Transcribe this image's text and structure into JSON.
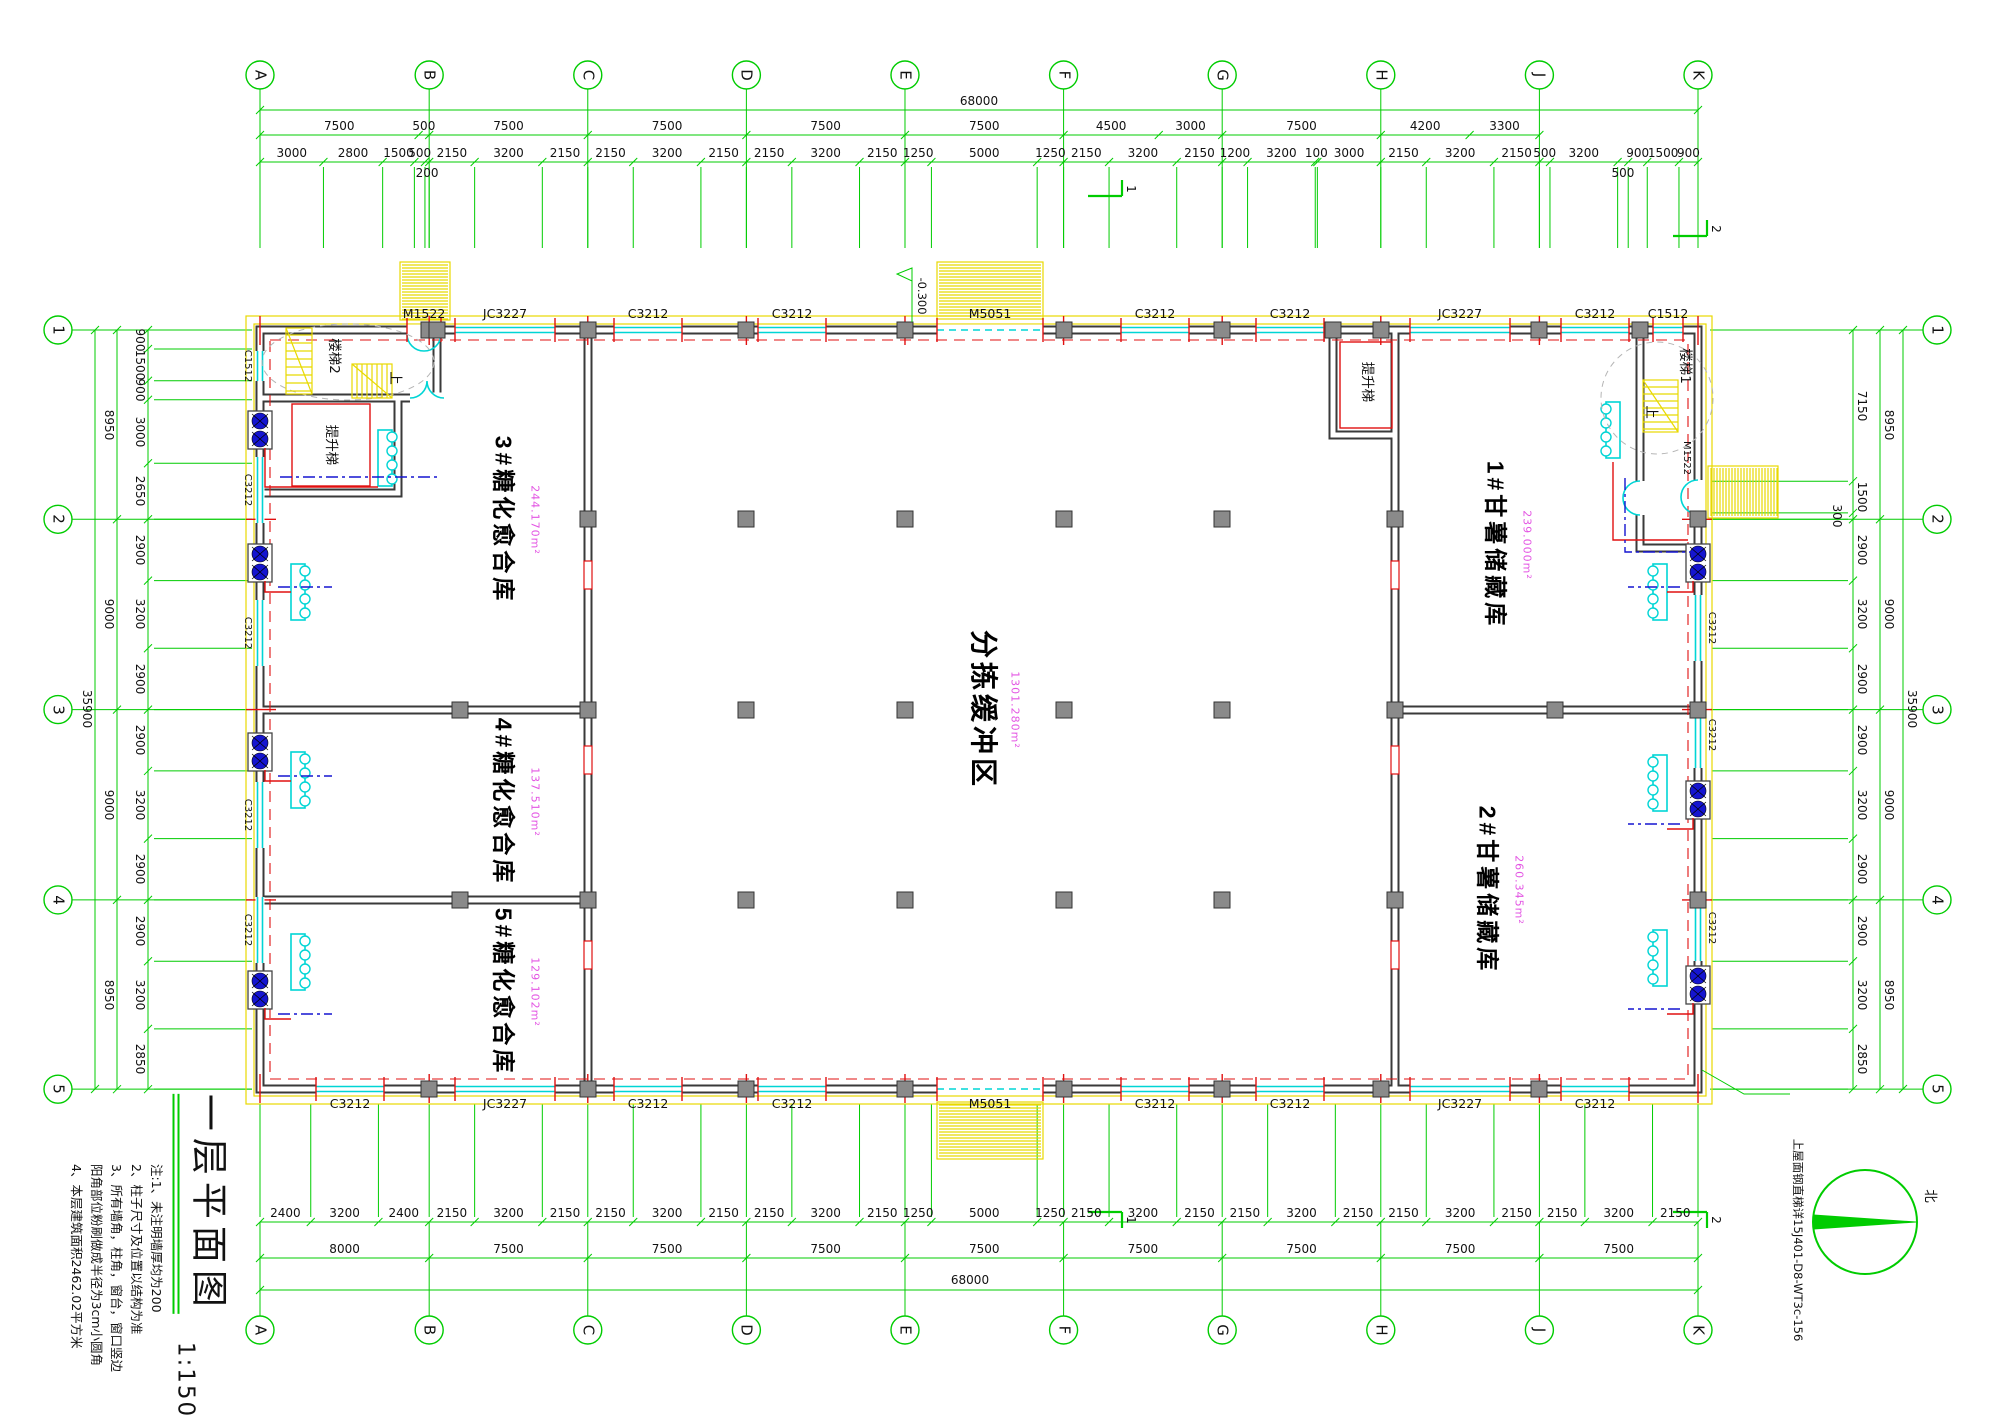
{
  "drawing": {
    "title": "一层平面图",
    "scale": "1:150",
    "notes": [
      "注:1、未注明墙厚均为200",
      "2、柱子尺寸及位置以结构为准",
      "3、所有墙角，柱角，窗台，窗口竖边",
      "阳角部位粉刷做成半径为3cm小圆角",
      "4、本层建筑面积2462.02平方米"
    ],
    "north_label": "北",
    "ladder_note": "上屋面钢直梯详15J401-D8-WT3c-156",
    "elevation": "-0.300"
  },
  "grid": {
    "cols": [
      "A",
      "B",
      "C",
      "D",
      "E",
      "F",
      "G",
      "H",
      "J",
      "K"
    ],
    "col_u": [
      0,
      8000,
      15500,
      23000,
      30500,
      38000,
      45500,
      53000,
      60500,
      68000
    ],
    "rows": [
      "1",
      "2",
      "3",
      "4",
      "5"
    ],
    "row_u": [
      0,
      8950,
      17950,
      26950,
      35900
    ]
  },
  "dims": {
    "top_total": "68000",
    "top_major": [
      7500,
      500,
      7500,
      7500,
      7500,
      7500,
      4500,
      3000,
      7500,
      4200,
      3300
    ],
    "top_detail": [
      3000,
      2800,
      1500,
      500,
      {
        "v": 200,
        "drop": true
      },
      2150,
      3200,
      2150,
      2150,
      3200,
      2150,
      2150,
      3200,
      2150,
      1250,
      5000,
      1250,
      2150,
      3200,
      2150,
      1200,
      3200,
      100,
      3000,
      2150,
      3200,
      2150,
      500,
      3200,
      {
        "v": 500,
        "drop": true
      },
      900,
      1500,
      900
    ],
    "bottom_total": "68000",
    "bottom_major": [
      8000,
      7500,
      7500,
      7500,
      7500,
      7500,
      7500,
      7500,
      7500
    ],
    "bottom_detail": [
      2400,
      3200,
      2400,
      2150,
      3200,
      2150,
      2150,
      3200,
      2150,
      2150,
      3200,
      2150,
      1250,
      5000,
      1250,
      2150,
      3200,
      2150,
      2150,
      3200,
      2150,
      2150,
      3200,
      2150,
      2150,
      3200,
      2150
    ],
    "left_total": "35900",
    "left_major": [
      8950,
      9000,
      9000,
      8950
    ],
    "left_detail": [
      900,
      1500,
      900,
      3000,
      2650,
      2900,
      3200,
      2900,
      2900,
      3200,
      2900,
      2900,
      3200,
      2850
    ],
    "right_total": "35900",
    "right_major": [
      8950,
      9000,
      9000,
      8950
    ],
    "right_detail": [
      7150,
      1500,
      {
        "v": 300,
        "drop": true
      },
      2900,
      3200,
      2900,
      2900,
      3200,
      2900,
      2900,
      3200,
      2850
    ]
  },
  "rooms": [
    {
      "name": "3#糖化愈合库",
      "area": "244.170m²",
      "x": 503,
      "y": 520
    },
    {
      "name": "4#糖化愈合库",
      "area": "137.510m²",
      "x": 503,
      "y": 802
    },
    {
      "name": "5#糖化愈合库",
      "area": "129.102m²",
      "x": 503,
      "y": 992
    },
    {
      "name": "分拣缓冲区",
      "area": "1301.280m²",
      "x": 983,
      "y": 710,
      "big": true
    },
    {
      "name": "1#甘薯储藏库",
      "area": "239.000m²",
      "x": 1495,
      "y": 545
    },
    {
      "name": "2#甘薯储藏库",
      "area": "260.345m²",
      "x": 1487,
      "y": 890
    }
  ],
  "stair_labels": [
    {
      "t": "楼梯2",
      "x": 333,
      "y": 356
    },
    {
      "t": "提升梯",
      "x": 330,
      "y": 445
    },
    {
      "t": "上",
      "x": 394,
      "y": 378
    },
    {
      "t": "楼梯1",
      "x": 1684,
      "y": 366
    },
    {
      "t": "提升梯",
      "x": 1366,
      "y": 382
    },
    {
      "t": "上",
      "x": 1650,
      "y": 412
    }
  ],
  "openings": {
    "top": [
      {
        "label": "M1522",
        "c": 424,
        "w": 34,
        "type": "swing"
      },
      {
        "label": "JC3227",
        "c": 505,
        "w": 100
      },
      {
        "label": "C3212",
        "c": 648,
        "w": 68
      },
      {
        "label": "C3212",
        "c": 792,
        "w": 68
      },
      {
        "label": "M5051",
        "c": 990,
        "w": 106,
        "type": "slide"
      },
      {
        "label": "C3212",
        "c": 1155,
        "w": 68
      },
      {
        "label": "C3212",
        "c": 1290,
        "w": 68
      },
      {
        "label": "JC3227",
        "c": 1460,
        "w": 100
      },
      {
        "label": "C3212",
        "c": 1595,
        "w": 68
      },
      {
        "label": "C1512",
        "c": 1668,
        "w": 30
      }
    ],
    "bottom": [
      {
        "label": "C3212",
        "c": 350,
        "w": 68
      },
      {
        "label": "JC3227",
        "c": 505,
        "w": 100
      },
      {
        "label": "C3212",
        "c": 648,
        "w": 68
      },
      {
        "label": "C3212",
        "c": 792,
        "w": 68
      },
      {
        "label": "M5051",
        "c": 990,
        "w": 106,
        "type": "slide"
      },
      {
        "label": "C3212",
        "c": 1155,
        "w": 68
      },
      {
        "label": "C3212",
        "c": 1290,
        "w": 68
      },
      {
        "label": "JC3227",
        "c": 1460,
        "w": 100
      },
      {
        "label": "C3212",
        "c": 1595,
        "w": 68
      }
    ],
    "left": [
      {
        "label": "C1512",
        "c": 366,
        "w": 30
      },
      {
        "label": "C3212",
        "c": 490,
        "w": 66
      },
      {
        "label": "C3212",
        "c": 633,
        "w": 66
      },
      {
        "label": "C3212",
        "c": 815,
        "w": 66
      },
      {
        "label": "C3212",
        "c": 930,
        "w": 66
      }
    ],
    "right": [
      {
        "label": "M1522",
        "c": 497,
        "w": 34,
        "type": "swing"
      },
      {
        "label": "C3212",
        "c": 628,
        "w": 66
      },
      {
        "label": "C3212",
        "c": 735,
        "w": 66
      },
      {
        "label": "C3212",
        "c": 928,
        "w": 66
      }
    ]
  },
  "sections": [
    {
      "n": "1",
      "x": 1105,
      "y": 196,
      "where": "top"
    },
    {
      "n": "1",
      "x": 1105,
      "y": 1212,
      "where": "bottom"
    },
    {
      "n": "2",
      "x": 1690,
      "y": 236,
      "where": "top"
    },
    {
      "n": "2",
      "x": 1690,
      "y": 1212,
      "where": "bottom"
    }
  ]
}
